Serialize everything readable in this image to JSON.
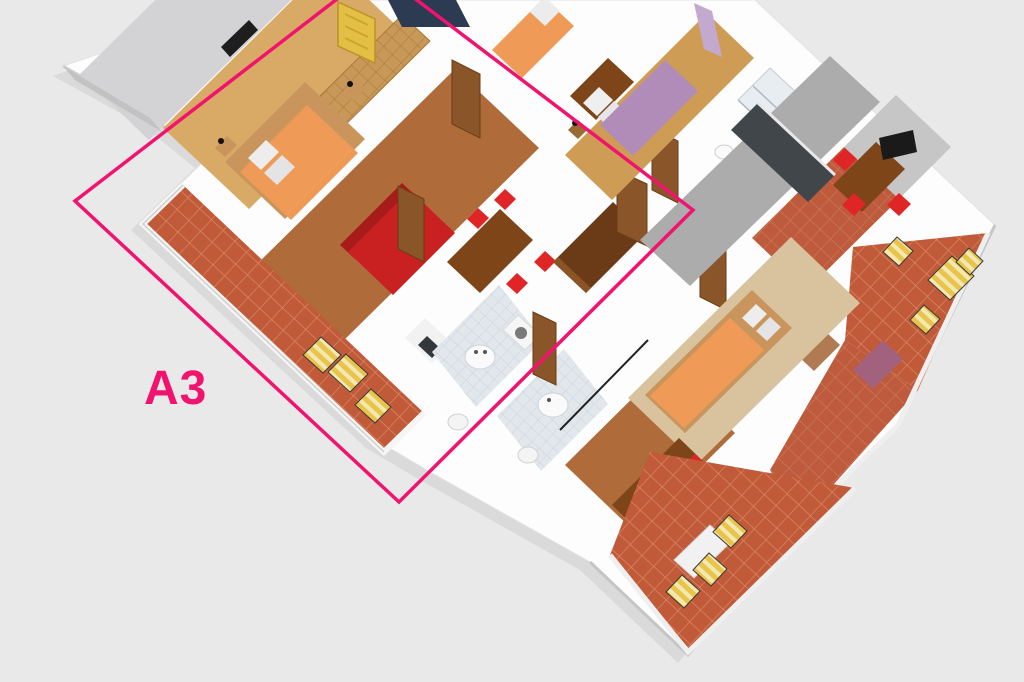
{
  "scene": {
    "type": "3d-floor-plan-render",
    "background_color": "#E9E9E9"
  },
  "highlight": {
    "unit_label": "A3",
    "outline_color": "#F0146E"
  },
  "palette": {
    "wall_white": "#FFFFFF",
    "wall_shadow": "#C7C7C7",
    "terrace_terracotta": "#C05A38",
    "wood_mid": "#AF6B3A",
    "wood_light": "#D9A966",
    "carpet_beige": "#D9C29E",
    "bed_orange": "#F09A58",
    "bed_purple": "#B18CB8",
    "sofa_red": "#C92121",
    "chair_red": "#DF2525",
    "table_brown": "#7E4518",
    "wardrobe_tan": "#C89858",
    "wardrobe_dark": "#6B3A16",
    "door_brown": "#8A5529",
    "door_yellow": "#E3C044",
    "kitchen_charcoal": "#41464B",
    "bath_tile": "#E2E7EC",
    "bath_floor_blue": "#3E5E8F",
    "lounger_yellow": "#E8C44C"
  },
  "rooms": [
    "empty-room-top-left",
    "a3-bedroom",
    "a3-living-dining",
    "a3-bathroom",
    "a3-terrace",
    "corridor",
    "purple-bedroom",
    "shower-bathroom",
    "kitchen-dining-top-right",
    "terrace-right",
    "bedroom-bottom",
    "dining-bottom",
    "terrace-bottom"
  ]
}
